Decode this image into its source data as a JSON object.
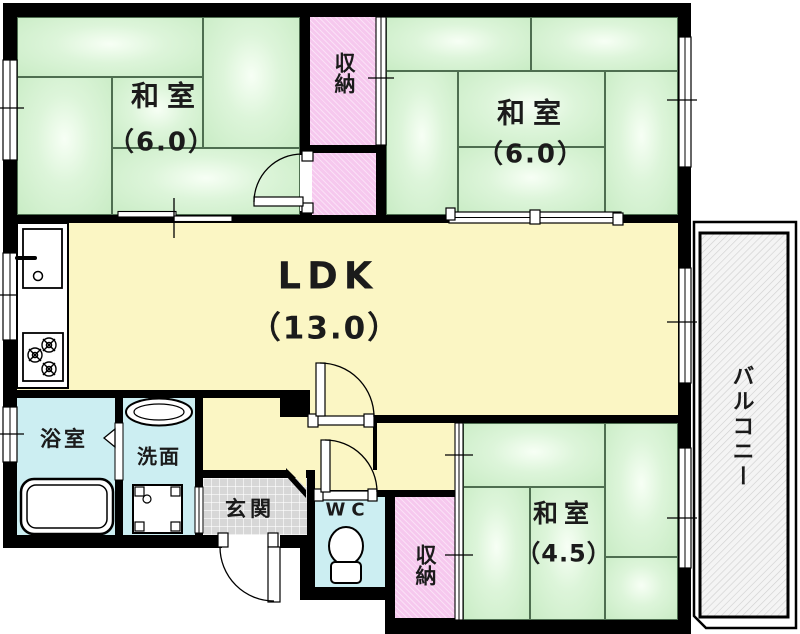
{
  "rooms": {
    "washitsu_nw": {
      "label": "和室",
      "size": "（6.0）"
    },
    "washitsu_ne": {
      "label": "和室",
      "size": "（6.0）"
    },
    "washitsu_se": {
      "label": "和室",
      "size": "（4.5）"
    },
    "ldk": {
      "label": "LDK",
      "size": "（13.0）"
    },
    "closet_top": {
      "label": "収納"
    },
    "closet_se": {
      "label": "収納"
    },
    "bathroom": {
      "label": "浴室"
    },
    "washroom": {
      "label": "洗面"
    },
    "genkan": {
      "label": "玄関"
    },
    "wc": {
      "label": "WC"
    },
    "balcony": {
      "label": "バルコニー"
    }
  },
  "colors": {
    "wall": "#000000",
    "tatami_green": "#c9ecc5",
    "ldk_yellow": "#fbf6c4",
    "closet_pink": "#f6c8ee",
    "wet_cyan": "#cceef2",
    "genkan_gray": "#d7d7d7",
    "balcony_hatch": "#f4f4f4"
  }
}
